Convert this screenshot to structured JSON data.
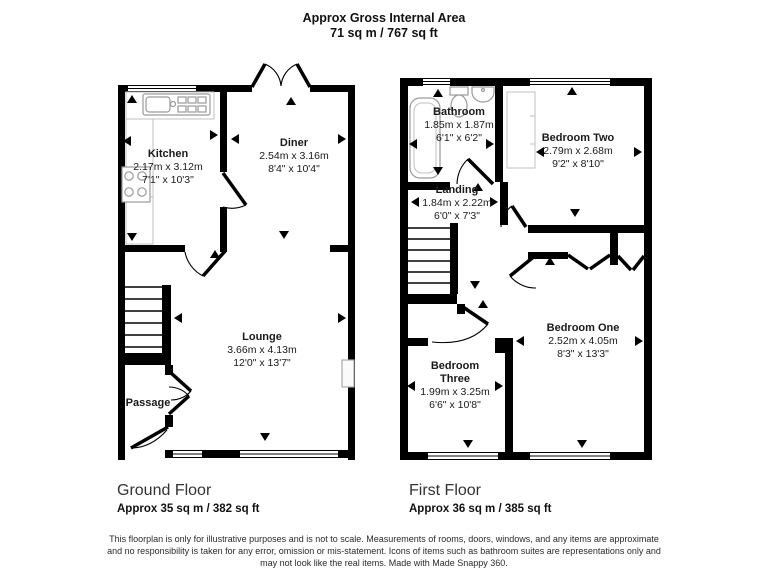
{
  "header": {
    "title": "Approx Gross Internal Area",
    "subtitle": "71 sq m / 767 sq ft"
  },
  "ground_floor": {
    "label": "Ground Floor",
    "area": "Approx 35 sq m / 382 sq ft",
    "rooms": {
      "kitchen": {
        "name": "Kitchen",
        "metric": "2.17m x 3.12m",
        "imperial": "7'1\" x 10'3\""
      },
      "diner": {
        "name": "Diner",
        "metric": "2.54m x 3.16m",
        "imperial": "8'4\" x 10'4\""
      },
      "lounge": {
        "name": "Lounge",
        "metric": "3.66m x 4.13m",
        "imperial": "12'0\" x 13'7\""
      },
      "passage": {
        "name": "Passage"
      }
    }
  },
  "first_floor": {
    "label": "First Floor",
    "area": "Approx 36 sq m / 385 sq ft",
    "rooms": {
      "bathroom": {
        "name": "Bathroom",
        "metric": "1.85m x 1.87m",
        "imperial": "6'1\" x 6'2\""
      },
      "bedroom_two": {
        "name": "Bedroom Two",
        "metric": "2.79m x 2.68m",
        "imperial": "9'2\" x 8'10\""
      },
      "landing": {
        "name": "Landing",
        "metric": "1.84m x 2.22m",
        "imperial": "6'0\" x 7'3\""
      },
      "bedroom_one": {
        "name": "Bedroom One",
        "metric": "2.52m x 4.05m",
        "imperial": "8'3\" x 13'3\""
      },
      "bedroom_three": {
        "name": "Bedroom Three",
        "metric": "1.99m x 3.25m",
        "imperial": "6'6\" x 10'8\""
      }
    }
  },
  "footer": {
    "line1": "This floorplan is only for illustrative purposes and is not to scale. Measurements of rooms, doors, windows, and any items are approximate",
    "line2": "and no responsibility is taken for any error, omission or mis-statement. Icons of items such as bathroom suites are representations only and",
    "line3": "may not look like the real items. Made with Made Snappy 360."
  },
  "colors": {
    "wall": "#000000",
    "text": "#1a1a1a",
    "fixture_stroke": "#9a9a9a"
  }
}
